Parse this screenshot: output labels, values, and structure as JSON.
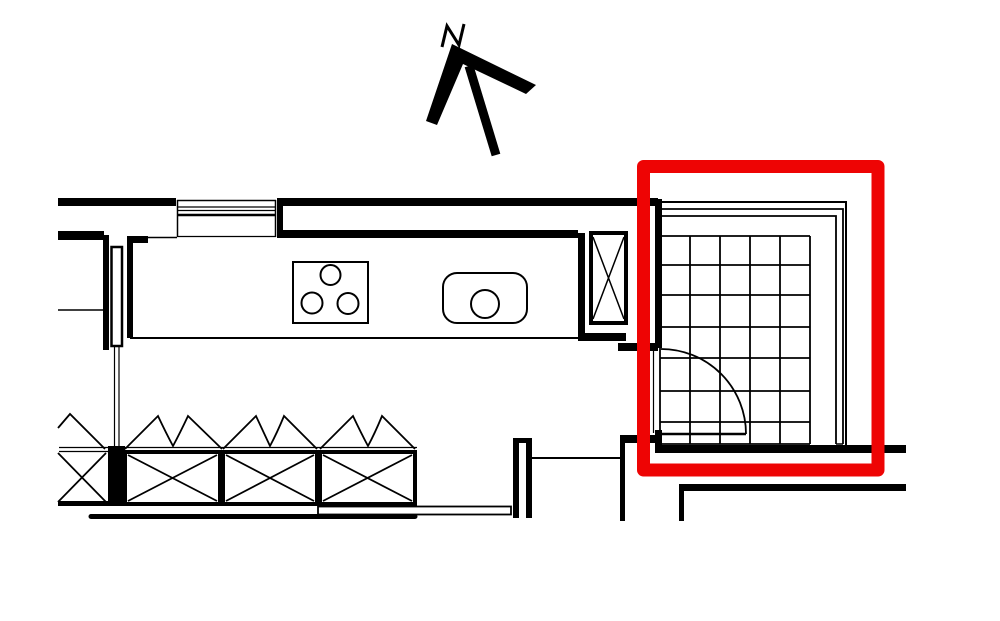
{
  "canvas": {
    "width": 1000,
    "height": 621,
    "background": "#ffffff",
    "ink": "#000000",
    "highlight": "#ee0404"
  },
  "north_arrow": {
    "label": "N",
    "letter_path": "M 442 47 L 447 26 L 459 45 L 464 24",
    "chevron_points": "426,121 452,44 536,85 526,94 463,64 437,125",
    "tail": {
      "x1": 469,
      "y1": 66,
      "x2": 496,
      "y2": 155,
      "sw": 9
    }
  },
  "tile_grid": {
    "cols": [
      660,
      690,
      720,
      750,
      780,
      810
    ],
    "rows": [
      236,
      265,
      295,
      327,
      358,
      391,
      422,
      444
    ],
    "x0": 660,
    "x1": 810,
    "y0": 236,
    "y1": 444,
    "sw": 1.8
  },
  "shapes": [
    {
      "t": "line",
      "name": "window-top-line",
      "x1": 177,
      "y1": 200.5,
      "x2": 276,
      "y2": 200.5,
      "sw": 1.5
    },
    {
      "t": "line",
      "name": "window-line-2",
      "x1": 177,
      "y1": 207,
      "x2": 276,
      "y2": 207,
      "sw": 1.2
    },
    {
      "t": "line",
      "name": "window-line-3",
      "x1": 177,
      "y1": 210.5,
      "x2": 276,
      "y2": 210.5,
      "sw": 1.2
    },
    {
      "t": "line",
      "name": "window-frame-line",
      "x1": 177,
      "y1": 215,
      "x2": 276,
      "y2": 215,
      "sw": 2.5
    },
    {
      "t": "line",
      "name": "window-sill-bottom",
      "x1": 177,
      "y1": 236.5,
      "x2": 276,
      "y2": 236.5,
      "sw": 1.2
    },
    {
      "t": "line",
      "name": "window-jamb-left-line",
      "x1": 177.5,
      "y1": 200,
      "x2": 177.5,
      "y2": 237,
      "sw": 1.5
    },
    {
      "t": "line",
      "name": "window-jamb-right-line",
      "x1": 275.5,
      "y1": 200,
      "x2": 275.5,
      "y2": 237,
      "sw": 1.5
    },
    {
      "t": "line",
      "name": "counter-top-edge",
      "x1": 133,
      "y1": 237.5,
      "x2": 177,
      "y2": 237.5,
      "sw": 1.5
    },
    {
      "t": "line",
      "name": "counter-bottom-edge",
      "x1": 130,
      "y1": 338,
      "x2": 578,
      "y2": 338,
      "sw": 2
    },
    {
      "t": "line",
      "name": "wall-thin-line",
      "x1": 58,
      "y1": 310,
      "x2": 103,
      "y2": 310,
      "sw": 1.5
    },
    {
      "t": "wall",
      "name": "top-wall-left",
      "x": 58,
      "y": 198,
      "w": 118,
      "h": 8
    },
    {
      "t": "wall",
      "name": "top-wall-right",
      "x": 277,
      "y": 198,
      "w": 381,
      "h": 8
    },
    {
      "t": "wall",
      "name": "window-jamb-right",
      "x": 277,
      "y": 198,
      "w": 6,
      "h": 39
    },
    {
      "t": "wall",
      "name": "inner-wall-left",
      "x": 58,
      "y": 231,
      "w": 46,
      "h": 9
    },
    {
      "t": "wall",
      "name": "kitchen-back-wall",
      "x": 277,
      "y": 230,
      "w": 301,
      "h": 8
    },
    {
      "t": "wall",
      "name": "kitchen-right-wall",
      "x": 578,
      "y": 233,
      "w": 7,
      "h": 108
    },
    {
      "t": "wall",
      "name": "wall-step-a",
      "x": 578,
      "y": 333,
      "w": 48,
      "h": 8
    },
    {
      "t": "wall",
      "name": "wall-step-b",
      "x": 618,
      "y": 343,
      "w": 40,
      "h": 8
    },
    {
      "t": "wall",
      "name": "room-left-wall-upper",
      "x": 655,
      "y": 199,
      "w": 7,
      "h": 149
    },
    {
      "t": "wall",
      "name": "room-left-wall-lower",
      "x": 655,
      "y": 430,
      "w": 7,
      "h": 22
    },
    {
      "t": "wall",
      "name": "door-jamb-wall",
      "x": 622,
      "y": 435,
      "w": 36,
      "h": 8
    },
    {
      "t": "wall",
      "name": "room-bottom-wall",
      "x": 655,
      "y": 445,
      "w": 251,
      "h": 8
    },
    {
      "t": "wall",
      "name": "lower-room-wall",
      "x": 679,
      "y": 484,
      "w": 227,
      "h": 7
    },
    {
      "t": "wall",
      "name": "wall-end-left",
      "x": 620,
      "y": 435,
      "w": 5,
      "h": 86
    },
    {
      "t": "wall",
      "name": "wall-end-right",
      "x": 679,
      "y": 484,
      "w": 5,
      "h": 37
    },
    {
      "t": "wall",
      "name": "pocket-jamb-left",
      "x": 103,
      "y": 235,
      "w": 6,
      "h": 115
    },
    {
      "t": "wall",
      "name": "counter-end-wall",
      "x": 127,
      "y": 236,
      "w": 6,
      "h": 102
    },
    {
      "t": "wall",
      "name": "wall-stub",
      "x": 127,
      "y": 236,
      "w": 21,
      "h": 7
    },
    {
      "t": "rect",
      "name": "pocket-door-leaf",
      "x": 111.5,
      "y": 247,
      "w": 10.5,
      "h": 99,
      "sw": 2.5,
      "fill": "#ffffff"
    },
    {
      "t": "line",
      "name": "pocket-door-track-left",
      "x1": 114.5,
      "y1": 346,
      "x2": 114.5,
      "y2": 446,
      "sw": 1.2
    },
    {
      "t": "line",
      "name": "pocket-door-track-right",
      "x1": 119,
      "y1": 346,
      "x2": 119,
      "y2": 446,
      "sw": 1.2
    },
    {
      "t": "rect",
      "name": "cooktop",
      "x": 293,
      "y": 262,
      "w": 75,
      "h": 61,
      "sw": 2
    },
    {
      "t": "circle",
      "name": "cooktop-burner-top",
      "cx": 330.5,
      "cy": 275,
      "r": 10,
      "sw": 2
    },
    {
      "t": "circle",
      "name": "cooktop-burner-left",
      "cx": 312,
      "cy": 303,
      "r": 10.5,
      "sw": 2
    },
    {
      "t": "circle",
      "name": "cooktop-burner-right",
      "cx": 348,
      "cy": 303.5,
      "r": 10.5,
      "sw": 2
    },
    {
      "t": "rect",
      "name": "sink-basin",
      "x": 443,
      "y": 273,
      "w": 84,
      "h": 50,
      "rx": 14,
      "sw": 2
    },
    {
      "t": "circle",
      "name": "sink-drain",
      "cx": 485,
      "cy": 304,
      "r": 14,
      "sw": 2
    },
    {
      "t": "rect",
      "name": "shaft-column",
      "x": 591,
      "y": 233,
      "w": 35,
      "h": 90,
      "sw": 4
    },
    {
      "t": "path",
      "name": "shaft-column-cross",
      "d": "M 593 237 L 624 319 M 624 237 L 593 319",
      "sw": 1.5
    },
    {
      "t": "polyline",
      "name": "wall-trim-outer",
      "points": "659,202 846,202 846,448",
      "sw": 2
    },
    {
      "t": "polyline",
      "name": "wall-trim-mid",
      "points": "661,209 843,209 843,444",
      "sw": 1.8
    },
    {
      "t": "polyline",
      "name": "wall-trim-inner",
      "points": "661,216 836,216 836,444",
      "sw": 1.8
    },
    {
      "t": "line",
      "name": "trim-end-cap-top",
      "x1": 660.5,
      "y1": 209,
      "x2": 660.5,
      "y2": 216,
      "sw": 1.5
    },
    {
      "t": "line",
      "name": "trim-end-cap-bot",
      "x1": 836,
      "y1": 444,
      "x2": 843,
      "y2": 444,
      "sw": 1.5
    },
    {
      "t": "grid",
      "name": "floor-tile-grid"
    },
    {
      "t": "line",
      "name": "door-leaf",
      "x1": 661,
      "y1": 434,
      "x2": 746,
      "y2": 434,
      "sw": 2.5
    },
    {
      "t": "path",
      "name": "door-swing-arc",
      "d": "M 746 434 A 85 85 0 0 0 661 349",
      "sw": 1.8
    },
    {
      "t": "line",
      "name": "door-opening-line",
      "x1": 653.5,
      "y1": 350,
      "x2": 653.5,
      "y2": 433,
      "sw": 1.2
    },
    {
      "t": "line",
      "name": "counter-front-edge-1",
      "x1": 59,
      "y1": 447.5,
      "x2": 417,
      "y2": 447.5,
      "sw": 1.3
    },
    {
      "t": "line",
      "name": "counter-front-edge-2",
      "x1": 59,
      "y1": 451.5,
      "x2": 417,
      "y2": 451.5,
      "sw": 1.3
    },
    {
      "t": "line",
      "name": "cabinet-partial-base",
      "x1": 58,
      "y1": 503.5,
      "x2": 108,
      "y2": 503.5,
      "sw": 5
    },
    {
      "t": "path",
      "name": "cabinet-partial-cross",
      "d": "M 58 453 L 106 502 M 58 502 L 106 453",
      "sw": 1.8
    },
    {
      "t": "wall",
      "name": "cabinet-jamb",
      "x": 108,
      "y": 446,
      "w": 17,
      "h": 60
    },
    {
      "t": "rect",
      "name": "cabinet-box-1",
      "x": 125,
      "y": 452,
      "w": 95,
      "h": 52,
      "sw": 4
    },
    {
      "t": "path",
      "name": "cabinet-cross-1",
      "d": "M 128 455 L 217 501 M 128 501 L 217 455",
      "sw": 1.8
    },
    {
      "t": "rect",
      "name": "cabinet-box-2",
      "x": 223,
      "y": 452,
      "w": 94,
      "h": 52,
      "sw": 4
    },
    {
      "t": "path",
      "name": "cabinet-cross-2",
      "d": "M 226 455 L 314 501 M 226 501 L 314 455",
      "sw": 1.8
    },
    {
      "t": "rect",
      "name": "cabinet-box-3",
      "x": 320,
      "y": 452,
      "w": 95,
      "h": 52,
      "sw": 4
    },
    {
      "t": "path",
      "name": "cabinet-cross-3",
      "d": "M 323 455 L 412 501 M 323 501 L 412 455",
      "sw": 1.8
    },
    {
      "t": "path",
      "name": "cabinet-door-symbol-0",
      "d": "M 58 428 L 70 414 L 105 449",
      "sw": 1.8
    },
    {
      "t": "path",
      "name": "cabinet-door-symbol-1",
      "d": "M 125 449 L 158 416 Q 166 433 173 446 Q 180 433 188 416 L 222 449",
      "sw": 1.8
    },
    {
      "t": "path",
      "name": "cabinet-door-symbol-2",
      "d": "M 223 449 L 256 416 Q 264 433 270 446 Q 277 433 284 416 L 317 449",
      "sw": 1.8
    },
    {
      "t": "path",
      "name": "cabinet-door-symbol-3",
      "d": "M 320 449 L 353 416 Q 361 433 368 446 Q 375 433 382 416 L 415 449",
      "sw": 1.8
    },
    {
      "t": "line",
      "name": "plinth-line",
      "x1": 91,
      "y1": 516.5,
      "x2": 415,
      "y2": 516.5,
      "sw": 5,
      "cap": "round"
    },
    {
      "t": "rect",
      "name": "tray-outline",
      "x": 318,
      "y": 506.5,
      "w": 193,
      "h": 8,
      "sw": 1.8
    },
    {
      "t": "wall",
      "name": "pier-cap",
      "x": 513,
      "y": 438,
      "w": 19,
      "h": 5
    },
    {
      "t": "wall",
      "name": "pier-left",
      "x": 513,
      "y": 441,
      "w": 6,
      "h": 77
    },
    {
      "t": "wall",
      "name": "pier-right",
      "x": 526,
      "y": 441,
      "w": 6,
      "h": 77
    },
    {
      "t": "line",
      "name": "lower-thin-line",
      "x1": 532,
      "y1": 458,
      "x2": 620,
      "y2": 458,
      "sw": 2
    },
    {
      "t": "path",
      "name": "north-letter-glyph",
      "d": "M 442 47 L 447 26 L 459 45 L 464 24",
      "sw": 3
    },
    {
      "t": "polygon",
      "name": "north-arrow-chevron",
      "points": "426,121 452,44 536,85 526,94 463,64 437,125"
    },
    {
      "t": "line",
      "name": "north-arrow-tail",
      "x1": 469,
      "y1": 66,
      "x2": 496,
      "y2": 155,
      "sw": 9
    },
    {
      "t": "rect",
      "name": "highlight-box",
      "x": 643.5,
      "y": 166.5,
      "w": 234.5,
      "h": 303.5,
      "sw": 13,
      "color": "#ee0404",
      "join": "round"
    }
  ]
}
